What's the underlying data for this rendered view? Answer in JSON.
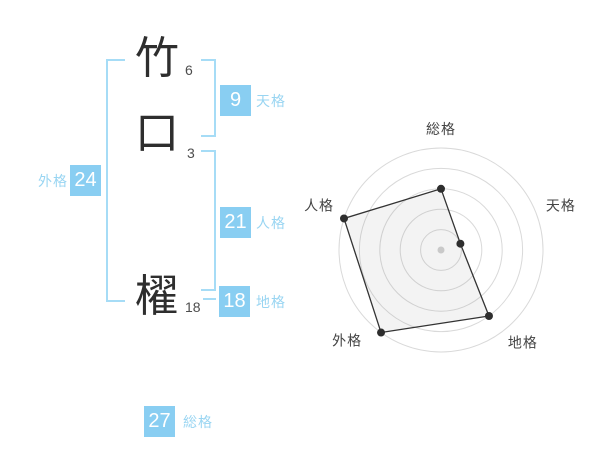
{
  "colors": {
    "background": "#ffffff",
    "accent_box": "#89cef2",
    "accent_label": "#99d5f2",
    "bracket_line": "#a6dcf6",
    "kanji_text": "#2e2e2e",
    "stroke_count_text": "#4d4d4d",
    "chart_ring": "#d9d9d9",
    "chart_line": "#333333",
    "chart_point": "#2e2e2e",
    "chart_center_dot": "#c9c9c9",
    "chart_label": "#444444"
  },
  "name": {
    "characters": [
      {
        "char": "竹",
        "strokes": "6"
      },
      {
        "char": "口",
        "strokes": "3"
      },
      {
        "char": "櫂",
        "strokes": "18"
      }
    ]
  },
  "fortune": {
    "tenkaku": {
      "label": "天格",
      "value": "9"
    },
    "jinkaku": {
      "label": "人格",
      "value": "21"
    },
    "chikaku": {
      "label": "地格",
      "value": "18"
    },
    "gaikaku": {
      "label": "外格",
      "value": "24"
    },
    "soukaku": {
      "label": "総格",
      "value": "27"
    }
  },
  "chart_data": {
    "type": "radar",
    "axes": [
      "総格",
      "天格",
      "地格",
      "外格",
      "人格"
    ],
    "values": [
      3,
      1,
      4,
      5,
      5
    ],
    "max": 5,
    "rings": 5,
    "start_angle_deg": 90,
    "direction": "clockwise",
    "grid": "circular",
    "legend": false,
    "center": {
      "x": 441,
      "y": 250
    },
    "radius": 102
  }
}
